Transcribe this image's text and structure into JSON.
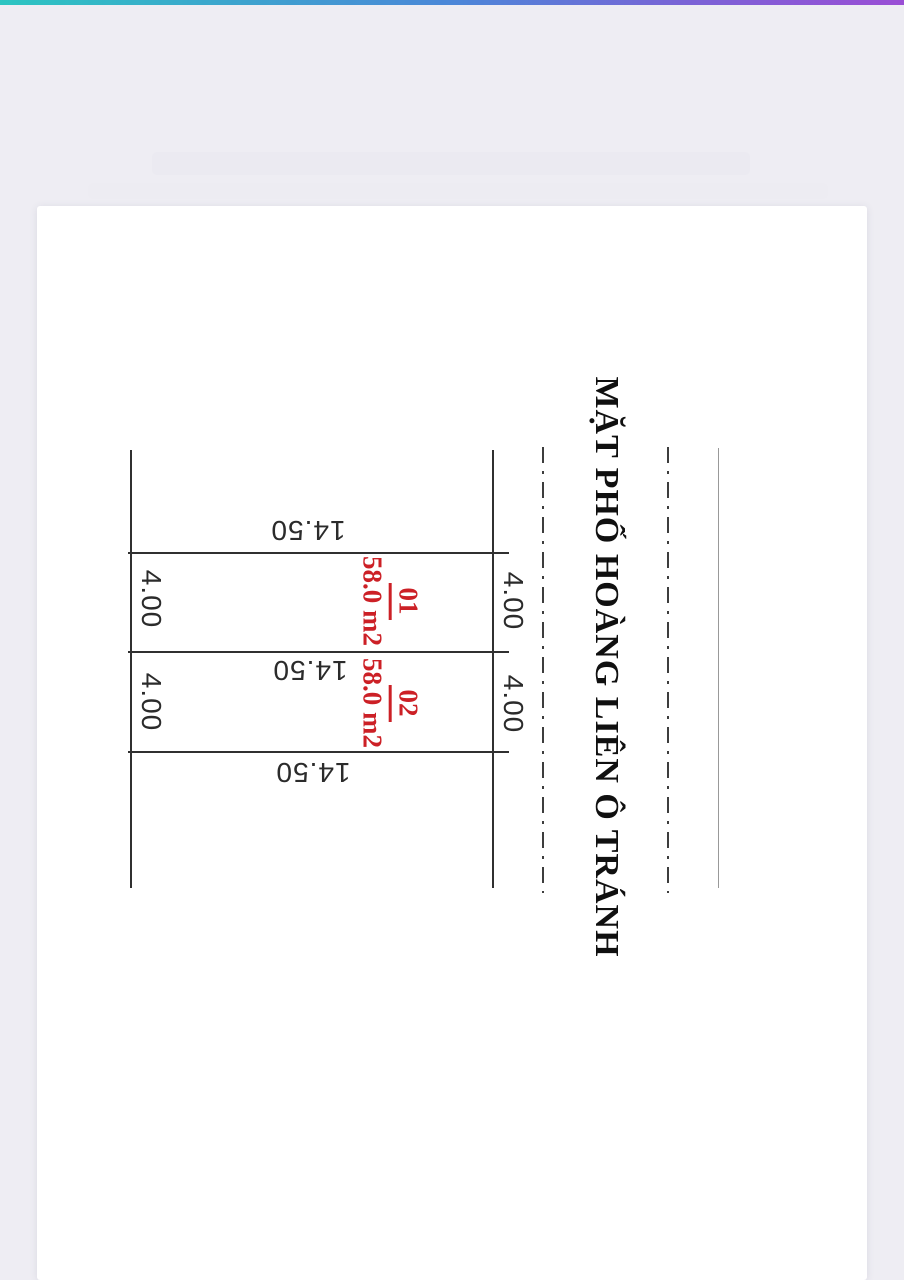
{
  "theme": {
    "accent_gradient": [
      "#2cc5c1",
      "#4b87d8",
      "#9a4ed5"
    ],
    "background_color": "#eeedf3",
    "page_color": "#ffffff",
    "line_color": "#303030",
    "dimension_text_color": "#2b2b2b",
    "plot_label_color": "#cc2026",
    "street_text_color": "#101010",
    "road_edge_line_color": "#999999"
  },
  "diagram": {
    "street_name": "MẶT PHỐ HOÀNG LIÊN Ô TRÁNH",
    "plots": [
      {
        "number": "01",
        "area": "58.0 m2"
      },
      {
        "number": "02",
        "area": "58.0 m2"
      }
    ],
    "depth_dims": [
      "14.50",
      "14.50",
      "14.50"
    ],
    "frontage_dims_left": [
      "4.00",
      "4.00"
    ],
    "frontage_dims_right": [
      "4.00",
      "4.00"
    ]
  }
}
